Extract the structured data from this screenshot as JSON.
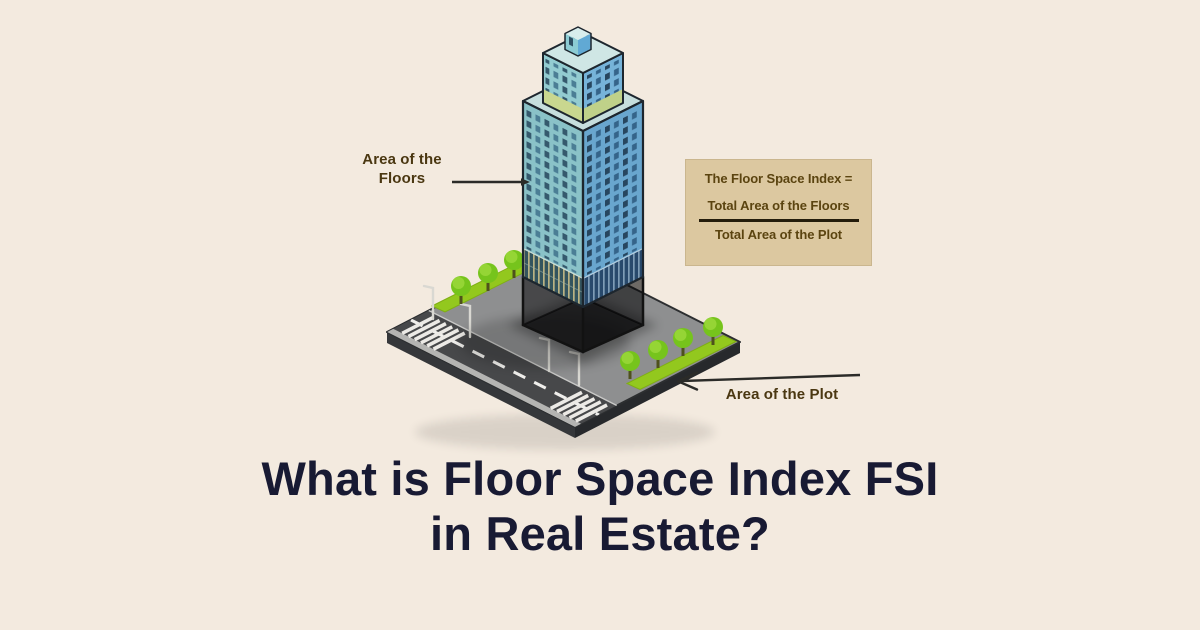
{
  "title": {
    "line1": "What is Floor Space Index FSI",
    "line2": "in Real Estate?"
  },
  "labels": {
    "floors_line1": "Area of the",
    "floors_line2": "Floors",
    "plot": "Area of the Plot"
  },
  "formula": {
    "heading": "The Floor Space Index =",
    "numerator": "Total Area of the Floors",
    "denominator": "Total Area of the Plot"
  },
  "colors": {
    "background": "#f3eadf",
    "title_text": "#181a33",
    "label_text": "#4a3711",
    "formula_box_bg": "#dcc8a0",
    "formula_text": "#5b4410",
    "building_left_face": "#8ac2c8",
    "building_right_face": "#69a6ce",
    "building_top": "#c6dedd",
    "plot_surface": "#8e8f90",
    "road": "#47484a",
    "sidewalk": "#b4b4b2",
    "grass": "#93c81e",
    "tree_canopy": "#76c41c",
    "arrow": "#2b2b28"
  }
}
